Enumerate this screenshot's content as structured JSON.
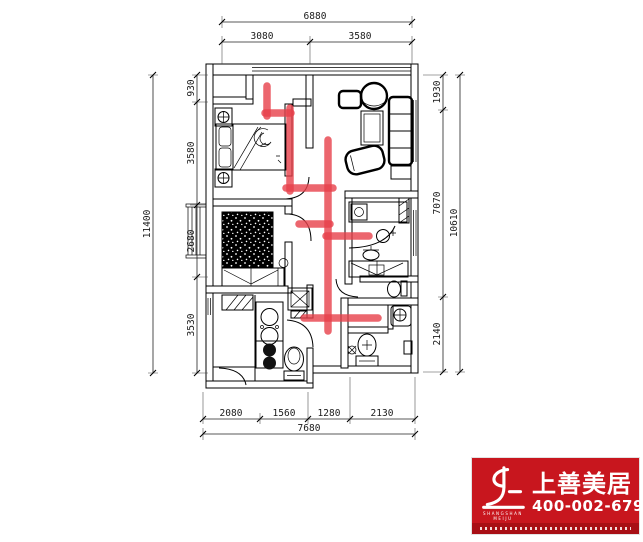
{
  "dimensions": {
    "top": {
      "total": "6880",
      "segments": [
        "3080",
        "3580"
      ]
    },
    "left": {
      "total": "11400",
      "segments": [
        "930",
        "3580",
        "2680",
        "3530"
      ]
    },
    "right": {
      "total": "10610",
      "segments": [
        "1930",
        "7070",
        "2140"
      ]
    },
    "bottom": {
      "total": "7680",
      "segments": [
        "2080",
        "1560",
        "1280",
        "2130"
      ]
    }
  },
  "logo": {
    "brand_cn": "上善美居",
    "brand_en_line1": "SHANGSHAN",
    "brand_en_line2": "MEIJU",
    "phone": "400-002-6791",
    "bg_color": "#c8161e",
    "strip_color": "#a80f15"
  },
  "annotations": {
    "marker_color": "#e8404a",
    "lines": [
      [
        267,
        86,
        267,
        116
      ],
      [
        265,
        113,
        291,
        113
      ],
      [
        290,
        108,
        290,
        191
      ],
      [
        286,
        188,
        333,
        188
      ],
      [
        328,
        140,
        328,
        331
      ],
      [
        299,
        224,
        330,
        224
      ],
      [
        326,
        236,
        369,
        236
      ],
      [
        304,
        318,
        378,
        318
      ]
    ]
  }
}
